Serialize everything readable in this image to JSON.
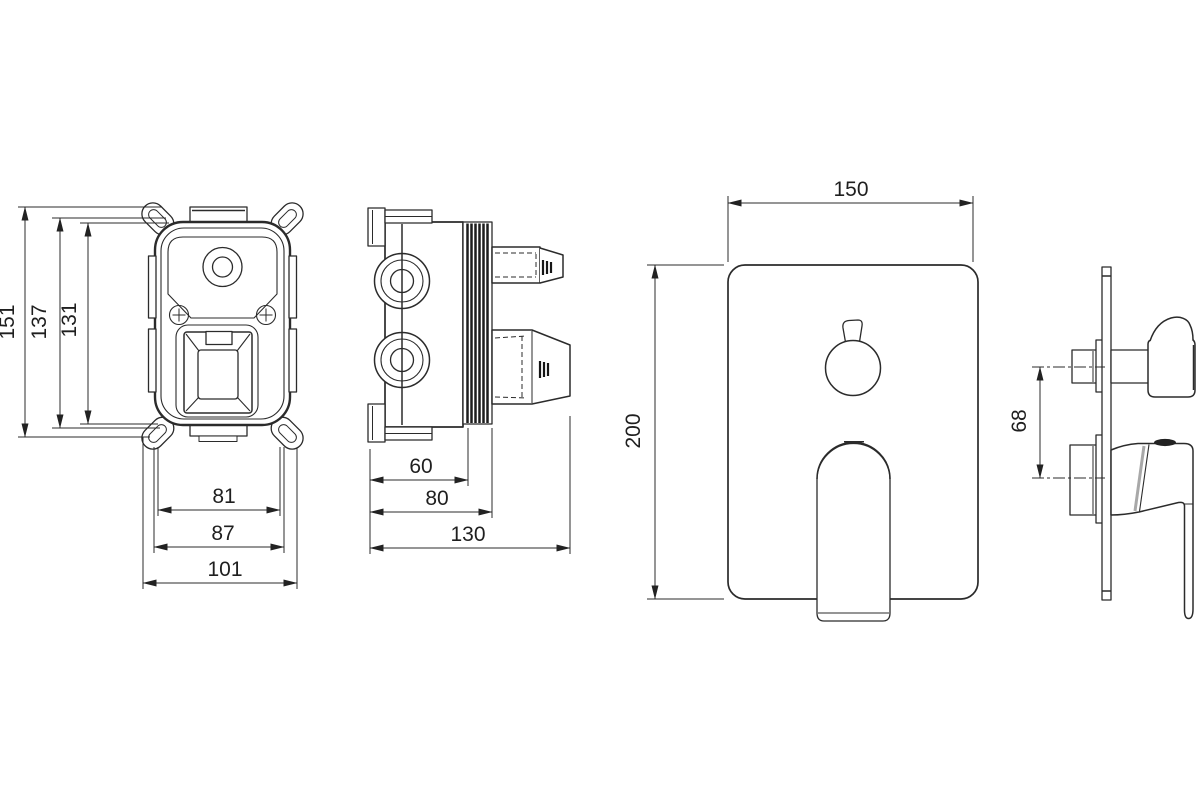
{
  "drawing": {
    "background": "#ffffff",
    "line_color": "#2b2b2b",
    "text_color": "#1f1f1f",
    "views": {
      "rough_in_front": {
        "dim_height_overall": "151",
        "dim_height_mounting": "137",
        "dim_height_body": "131",
        "dim_width_body": "81",
        "dim_width_mounting": "87",
        "dim_width_overall": "101"
      },
      "rough_in_side": {
        "dim_depth_body": "60",
        "dim_depth_to_flange": "80",
        "dim_depth_overall": "130"
      },
      "trim_front": {
        "dim_width": "150",
        "dim_height": "200"
      },
      "trim_side": {
        "dim_handle_axis_spacing": "68"
      }
    }
  }
}
